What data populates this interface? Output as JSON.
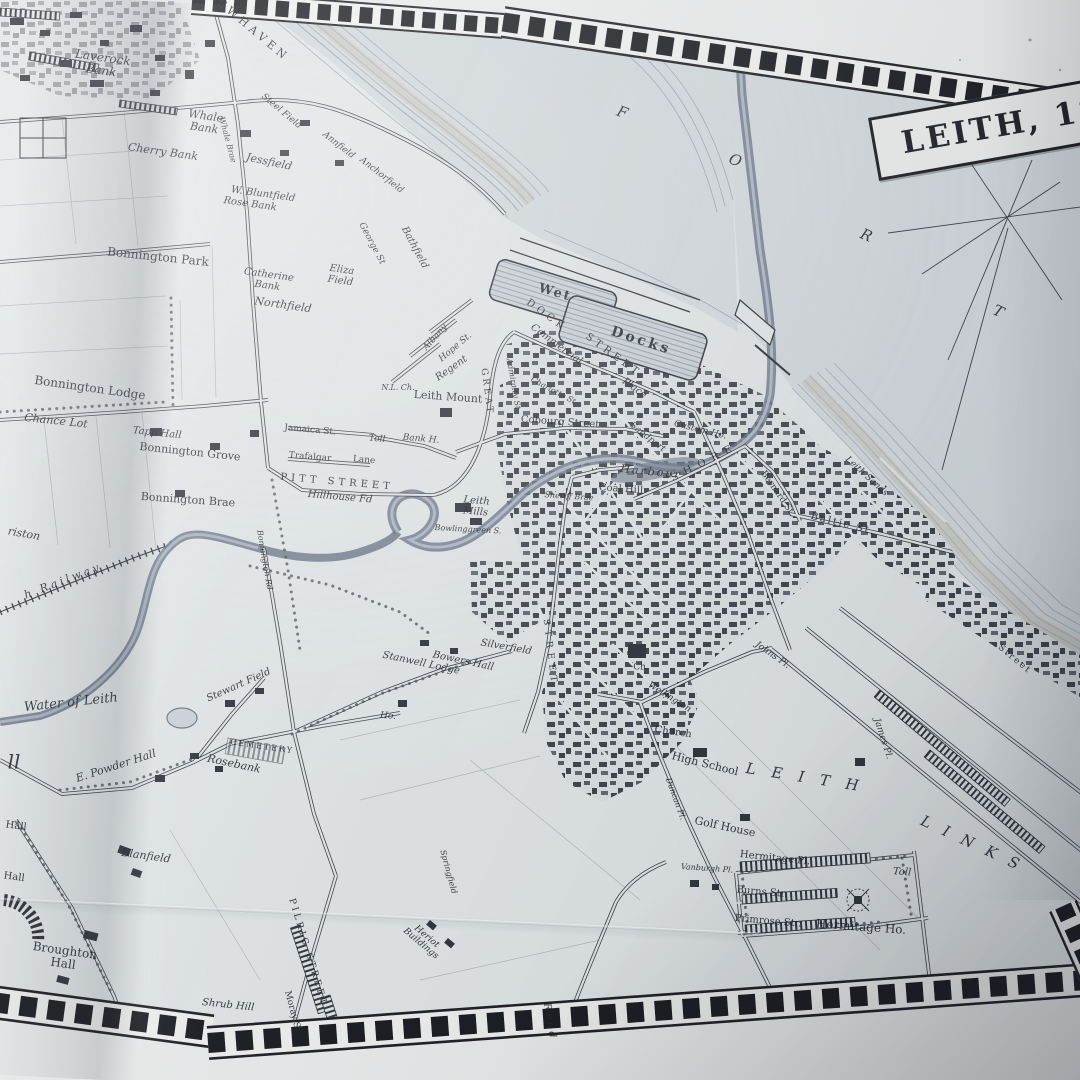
{
  "map": {
    "title": "LEITH, 18",
    "colors": {
      "paper": "#e4e8e9",
      "margin": "#edefee",
      "sea": "#d5dbde",
      "ink": "#2b2e33",
      "river": "#6b7486",
      "shore_tan": "#c2bba8"
    },
    "labels": [
      {
        "t": "NEWHAVEN",
        "x": 248,
        "y": 26,
        "r": 40,
        "s": 11,
        "sp": 4
      },
      {
        "t": "Laverock\nBank",
        "x": 102,
        "y": 64,
        "r": 8,
        "s": 12,
        "i": 1
      },
      {
        "t": "Whale\nBank",
        "x": 205,
        "y": 122,
        "r": 8,
        "s": 11,
        "i": 1
      },
      {
        "t": "Whale Brae",
        "x": 227,
        "y": 140,
        "r": 75,
        "s": 8,
        "i": 1
      },
      {
        "t": "Cherry Bank",
        "x": 163,
        "y": 152,
        "r": 8,
        "s": 11,
        "i": 1
      },
      {
        "t": "Jessfield",
        "x": 269,
        "y": 162,
        "r": 12,
        "s": 11,
        "i": 1
      },
      {
        "t": "Steel Field",
        "x": 281,
        "y": 112,
        "r": 40,
        "s": 9,
        "i": 1
      },
      {
        "t": "W. Bluntfield",
        "x": 263,
        "y": 195,
        "r": 8,
        "s": 10,
        "i": 1
      },
      {
        "t": "Rose Bank",
        "x": 250,
        "y": 205,
        "r": 8,
        "s": 10,
        "i": 1
      },
      {
        "t": "Annfield",
        "x": 338,
        "y": 146,
        "r": 38,
        "s": 9,
        "i": 1
      },
      {
        "t": "Anchorfield",
        "x": 381,
        "y": 176,
        "r": 38,
        "s": 9,
        "i": 1
      },
      {
        "t": "George St",
        "x": 371,
        "y": 244,
        "r": 62,
        "s": 9,
        "i": 1
      },
      {
        "t": "Bathfield",
        "x": 414,
        "y": 248,
        "r": 62,
        "s": 10,
        "i": 1
      },
      {
        "t": "Eliza\nField",
        "x": 341,
        "y": 276,
        "r": 8,
        "s": 10,
        "i": 1
      },
      {
        "t": "Catherine\nBank",
        "x": 268,
        "y": 281,
        "r": 8,
        "s": 10,
        "i": 1
      },
      {
        "t": "Northfield",
        "x": 283,
        "y": 305,
        "r": 8,
        "s": 11,
        "i": 1
      },
      {
        "t": "Bonnington Park",
        "x": 158,
        "y": 257,
        "r": 6,
        "s": 12
      },
      {
        "t": "Bonnington Lodge",
        "x": 90,
        "y": 388,
        "r": 8,
        "s": 12
      },
      {
        "t": "Chance Lot",
        "x": 56,
        "y": 421,
        "r": 6,
        "s": 11,
        "i": 1
      },
      {
        "t": "Tapp Hall",
        "x": 157,
        "y": 434,
        "r": 6,
        "s": 10,
        "i": 1
      },
      {
        "t": "Bonnington Grove",
        "x": 190,
        "y": 452,
        "r": 6,
        "s": 11
      },
      {
        "t": "Bonnington Brae",
        "x": 188,
        "y": 500,
        "r": 4,
        "s": 11
      },
      {
        "t": "riston",
        "x": 24,
        "y": 534,
        "r": 10,
        "s": 11,
        "i": 1
      },
      {
        "t": "Jamaica St.",
        "x": 310,
        "y": 431,
        "r": 5,
        "s": 9
      },
      {
        "t": "Toll",
        "x": 377,
        "y": 440,
        "r": 5,
        "s": 9,
        "i": 1
      },
      {
        "t": "Bank H.",
        "x": 421,
        "y": 440,
        "r": 5,
        "s": 9,
        "i": 1
      },
      {
        "t": "Trafalgar",
        "x": 310,
        "y": 458,
        "r": 5,
        "s": 9
      },
      {
        "t": "Lane",
        "x": 364,
        "y": 461,
        "r": 5,
        "s": 9
      },
      {
        "t": "PITT STREET",
        "x": 337,
        "y": 483,
        "r": 5,
        "s": 10,
        "sp": 4
      },
      {
        "t": "Hillhouse Fd",
        "x": 340,
        "y": 498,
        "r": 5,
        "s": 10,
        "i": 1
      },
      {
        "t": "Bonnington Rd",
        "x": 264,
        "y": 560,
        "r": 80,
        "s": 8,
        "i": 1
      },
      {
        "t": "Leith\nMills",
        "x": 476,
        "y": 507,
        "r": 5,
        "s": 10,
        "i": 1
      },
      {
        "t": "Bowlinggreen S.",
        "x": 468,
        "y": 530,
        "r": 3,
        "s": 8,
        "i": 1
      },
      {
        "t": "N.L. Ch.",
        "x": 398,
        "y": 388,
        "r": 0,
        "s": 8,
        "i": 1
      },
      {
        "t": "Albany",
        "x": 436,
        "y": 338,
        "r": -48,
        "s": 9,
        "i": 1
      },
      {
        "t": "Hope St.",
        "x": 456,
        "y": 348,
        "r": -40,
        "s": 9,
        "i": 1
      },
      {
        "t": "Regent",
        "x": 452,
        "y": 369,
        "r": -35,
        "s": 10,
        "i": 1
      },
      {
        "t": "Leith Mount",
        "x": 448,
        "y": 397,
        "r": 4,
        "s": 11
      },
      {
        "t": "GREAT",
        "x": 486,
        "y": 392,
        "r": 82,
        "s": 9,
        "sp": 3
      },
      {
        "t": "Admiralty St",
        "x": 513,
        "y": 384,
        "r": 80,
        "s": 8,
        "i": 1
      },
      {
        "t": "Charlotte St",
        "x": 553,
        "y": 391,
        "r": 28,
        "s": 8,
        "i": 1
      },
      {
        "t": "Cobourg Street",
        "x": 560,
        "y": 423,
        "r": 4,
        "s": 10
      },
      {
        "t": "Commercial",
        "x": 556,
        "y": 345,
        "r": 36,
        "s": 10,
        "i": 1
      },
      {
        "t": "Place",
        "x": 634,
        "y": 389,
        "r": 36,
        "s": 10,
        "i": 1
      },
      {
        "t": "DOCK",
        "x": 546,
        "y": 316,
        "r": 36,
        "s": 10,
        "sp": 4
      },
      {
        "t": "STREET",
        "x": 613,
        "y": 356,
        "r": 36,
        "s": 10,
        "sp": 4
      },
      {
        "t": "Wet",
        "x": 555,
        "y": 293,
        "r": 16,
        "s": 13,
        "sp": 2,
        "w": 700
      },
      {
        "t": "Docks",
        "x": 641,
        "y": 341,
        "r": 18,
        "s": 14,
        "sp": 3,
        "w": 700
      },
      {
        "t": "Custom Ho.",
        "x": 700,
        "y": 431,
        "r": 14,
        "s": 9,
        "i": 1
      },
      {
        "t": "Sandport",
        "x": 647,
        "y": 438,
        "r": 38,
        "s": 9,
        "i": 1
      },
      {
        "t": "Harbour",
        "x": 651,
        "y": 472,
        "r": 6,
        "s": 11,
        "sp": 2,
        "i": 1
      },
      {
        "t": "Coal Hill",
        "x": 621,
        "y": 490,
        "r": 4,
        "s": 10
      },
      {
        "t": "SHORE",
        "x": 705,
        "y": 463,
        "r": -27,
        "s": 10,
        "sp": 7
      },
      {
        "t": "Sheriff Brae",
        "x": 569,
        "y": 497,
        "r": 4,
        "s": 8,
        "i": 1
      },
      {
        "t": "Bernard St.",
        "x": 777,
        "y": 494,
        "r": 55,
        "s": 9
      },
      {
        "t": "Baltic St.",
        "x": 843,
        "y": 525,
        "r": 14,
        "s": 10,
        "sp": 2
      },
      {
        "t": "Leith Sands",
        "x": 866,
        "y": 477,
        "r": 42,
        "s": 9,
        "i": 1
      },
      {
        "t": "Street",
        "x": 1014,
        "y": 660,
        "r": 40,
        "s": 9,
        "sp": 2
      },
      {
        "t": "LEITH",
        "x": 810,
        "y": 779,
        "r": 9,
        "s": 15,
        "sp": 16,
        "i": 1
      },
      {
        "t": "LINKS",
        "x": 976,
        "y": 846,
        "r": 25,
        "s": 15,
        "sp": 14,
        "i": 1
      },
      {
        "t": "Johns Pl.",
        "x": 772,
        "y": 656,
        "r": 35,
        "s": 9,
        "i": 1
      },
      {
        "t": "James Pl.",
        "x": 882,
        "y": 739,
        "r": 72,
        "s": 9,
        "i": 1
      },
      {
        "t": "Wellington",
        "x": 669,
        "y": 698,
        "r": 32,
        "s": 9,
        "i": 1
      },
      {
        "t": "Church",
        "x": 673,
        "y": 733,
        "r": 8,
        "s": 10
      },
      {
        "t": "High School",
        "x": 705,
        "y": 764,
        "r": 14,
        "s": 11
      },
      {
        "t": "Golf House",
        "x": 725,
        "y": 827,
        "r": 12,
        "s": 11
      },
      {
        "t": "Duncan Pl.",
        "x": 675,
        "y": 799,
        "r": 70,
        "s": 8,
        "i": 1
      },
      {
        "t": "Ch.",
        "x": 641,
        "y": 668,
        "r": 0,
        "s": 9
      },
      {
        "t": "Hermitage Pl.",
        "x": 775,
        "y": 859,
        "r": 6,
        "s": 10
      },
      {
        "t": "Burns Str.",
        "x": 762,
        "y": 893,
        "r": 5,
        "s": 10
      },
      {
        "t": "Primrose Str.",
        "x": 768,
        "y": 922,
        "r": 5,
        "s": 10
      },
      {
        "t": "Hermitage Ho.",
        "x": 861,
        "y": 927,
        "r": 4,
        "s": 12
      },
      {
        "t": "Toll",
        "x": 902,
        "y": 873,
        "r": 5,
        "s": 10,
        "i": 1
      },
      {
        "t": "Water of Leith",
        "x": 71,
        "y": 703,
        "r": -6,
        "s": 13,
        "i": 1
      },
      {
        "t": "Stewart Field",
        "x": 239,
        "y": 686,
        "r": -24,
        "s": 10,
        "i": 1
      },
      {
        "t": "E. Powder Hall",
        "x": 116,
        "y": 766,
        "r": -18,
        "s": 11,
        "i": 1
      },
      {
        "t": "CEMETERY",
        "x": 262,
        "y": 747,
        "r": 8,
        "s": 8,
        "sp": 2
      },
      {
        "t": "Rosebank",
        "x": 234,
        "y": 764,
        "r": 12,
        "s": 11,
        "i": 1
      },
      {
        "t": "ll",
        "x": 14,
        "y": 762,
        "r": 0,
        "s": 20,
        "i": 1
      },
      {
        "t": "h Railway",
        "x": 63,
        "y": 581,
        "r": -21,
        "s": 11,
        "sp": 3,
        "i": 1
      },
      {
        "t": "Blanfield",
        "x": 146,
        "y": 856,
        "r": 8,
        "s": 11,
        "i": 1
      },
      {
        "t": "Broughton\nHall",
        "x": 64,
        "y": 957,
        "r": 8,
        "s": 12
      },
      {
        "t": "Hall",
        "x": 16,
        "y": 827,
        "r": 8,
        "s": 10
      },
      {
        "t": "Hall",
        "x": 14,
        "y": 878,
        "r": 8,
        "s": 10
      },
      {
        "t": "Shrub Hill",
        "x": 228,
        "y": 1006,
        "r": 6,
        "s": 10,
        "i": 1
      },
      {
        "t": "PILRIG STREET",
        "x": 307,
        "y": 953,
        "r": 73,
        "s": 9,
        "sp": 3
      },
      {
        "t": "Moray St.",
        "x": 292,
        "y": 1013,
        "r": 75,
        "s": 9
      },
      {
        "t": "Heriot\nBuildings",
        "x": 423,
        "y": 941,
        "r": 40,
        "s": 9,
        "i": 1
      },
      {
        "t": "Road",
        "x": 549,
        "y": 1022,
        "r": 80,
        "s": 10,
        "sp": 3,
        "i": 1
      },
      {
        "t": "Springfield",
        "x": 448,
        "y": 872,
        "r": 75,
        "s": 8,
        "i": 1
      },
      {
        "t": "Vanburgh Pl.",
        "x": 707,
        "y": 869,
        "r": 4,
        "s": 8,
        "i": 1
      },
      {
        "t": "Stanwell Lodge",
        "x": 421,
        "y": 664,
        "r": 12,
        "s": 10,
        "i": 1
      },
      {
        "t": "Bowers Hall",
        "x": 463,
        "y": 662,
        "r": 12,
        "s": 10,
        "i": 1
      },
      {
        "t": "Silverfield",
        "x": 506,
        "y": 648,
        "r": 10,
        "s": 10,
        "i": 1
      },
      {
        "t": "Ho.",
        "x": 388,
        "y": 717,
        "r": 5,
        "s": 9,
        "i": 1
      },
      {
        "t": "STREET",
        "x": 549,
        "y": 653,
        "r": 83,
        "s": 9,
        "sp": 5
      },
      {
        "t": "F",
        "x": 622,
        "y": 113,
        "r": 20,
        "s": 15,
        "i": 1
      },
      {
        "t": "O",
        "x": 735,
        "y": 161,
        "r": 22,
        "s": 15,
        "i": 1
      },
      {
        "t": "R",
        "x": 866,
        "y": 236,
        "r": 24,
        "s": 15,
        "i": 1
      },
      {
        "t": "T",
        "x": 998,
        "y": 312,
        "r": 26,
        "s": 15,
        "i": 1
      }
    ]
  }
}
